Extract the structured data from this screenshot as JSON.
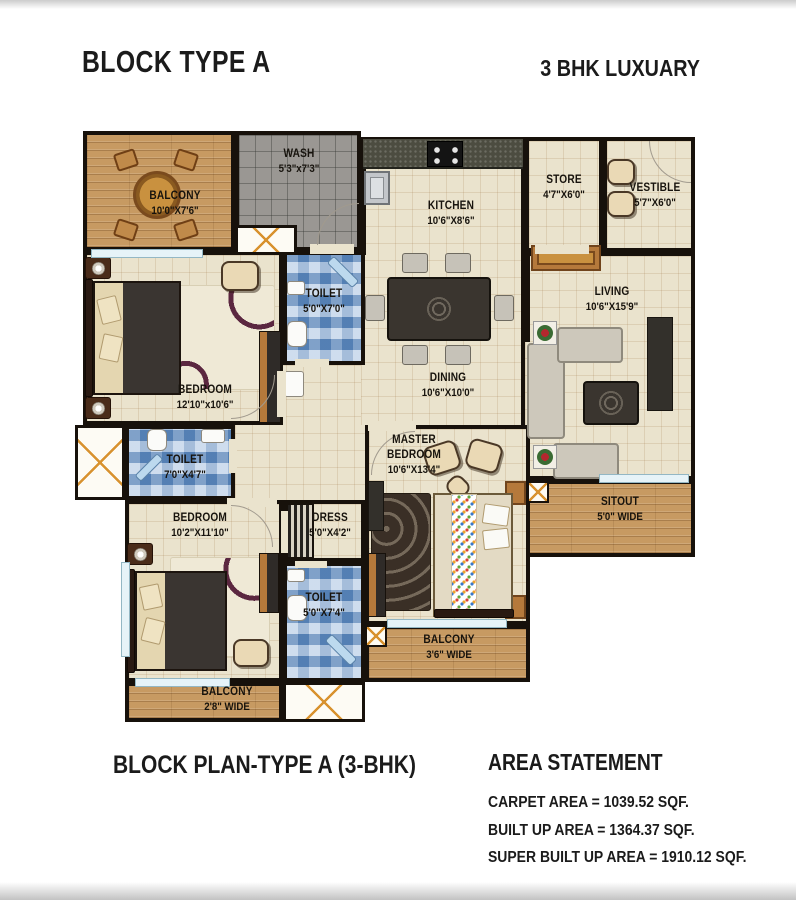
{
  "header": {
    "title": "BLOCK TYPE A",
    "subtitle": "3 BHK LUXUARY"
  },
  "rooms": {
    "balcony_tl": {
      "name": "BALCONY",
      "dims": "10'0\"X7'6\""
    },
    "wash": {
      "name": "WASH",
      "dims": "5'3\"x7'3\""
    },
    "kitchen": {
      "name": "KITCHEN",
      "dims": "10'6\"X8'6\""
    },
    "store": {
      "name": "STORE",
      "dims": "4'7\"X6'0\""
    },
    "vestible": {
      "name": "VESTIBLE",
      "dims": "5'7\"X6'0\""
    },
    "living": {
      "name": "LIVING",
      "dims": "10'6\"X15'9\""
    },
    "dining": {
      "name": "DINING",
      "dims": "10'6\"X10'0\""
    },
    "toilet_1": {
      "name": "TOILET",
      "dims": "5'0\"X7'0\""
    },
    "bedroom_1": {
      "name": "BEDROOM",
      "dims": "12'10\"x10'6\""
    },
    "toilet_2": {
      "name": "TOILET",
      "dims": "7'0\"X4'7\""
    },
    "bedroom_2": {
      "name": "BEDROOM",
      "dims": "10'2\"X11'10\""
    },
    "dress": {
      "name": "DRESS",
      "dims": "5'0\"X4'2\""
    },
    "toilet_3": {
      "name": "TOILET",
      "dims": "5'0\"X7'4\""
    },
    "master_bedroom": {
      "name": "MASTER BEDROOM",
      "dims": "10'6\"X13'4\""
    },
    "sitout": {
      "name": "SITOUT",
      "dims": "5'0\" WIDE"
    },
    "balcony_36": {
      "name": "BALCONY",
      "dims": "3'6\" WIDE"
    },
    "balcony_28": {
      "name": "BALCONY",
      "dims": "2'8\" WIDE"
    }
  },
  "footer": {
    "plan_title": "BLOCK PLAN-TYPE A (3-BHK)",
    "area_title": "AREA STATEMENT",
    "area_lines": [
      "CARPET AREA = 1039.52 SQF.",
      "BUILT UP AREA = 1364.37 SQF.",
      "SUPER BUILT UP AREA = 1910.12 SQF."
    ]
  },
  "colors": {
    "wall": "#17110b",
    "wood_floor": "#c79a62",
    "tile_blue": "#8fb0d8",
    "tile_gray": "#9a9793",
    "floor_cream": "#eae3cd",
    "accent_orange": "#d8922f",
    "text": "#1b1b1b"
  }
}
